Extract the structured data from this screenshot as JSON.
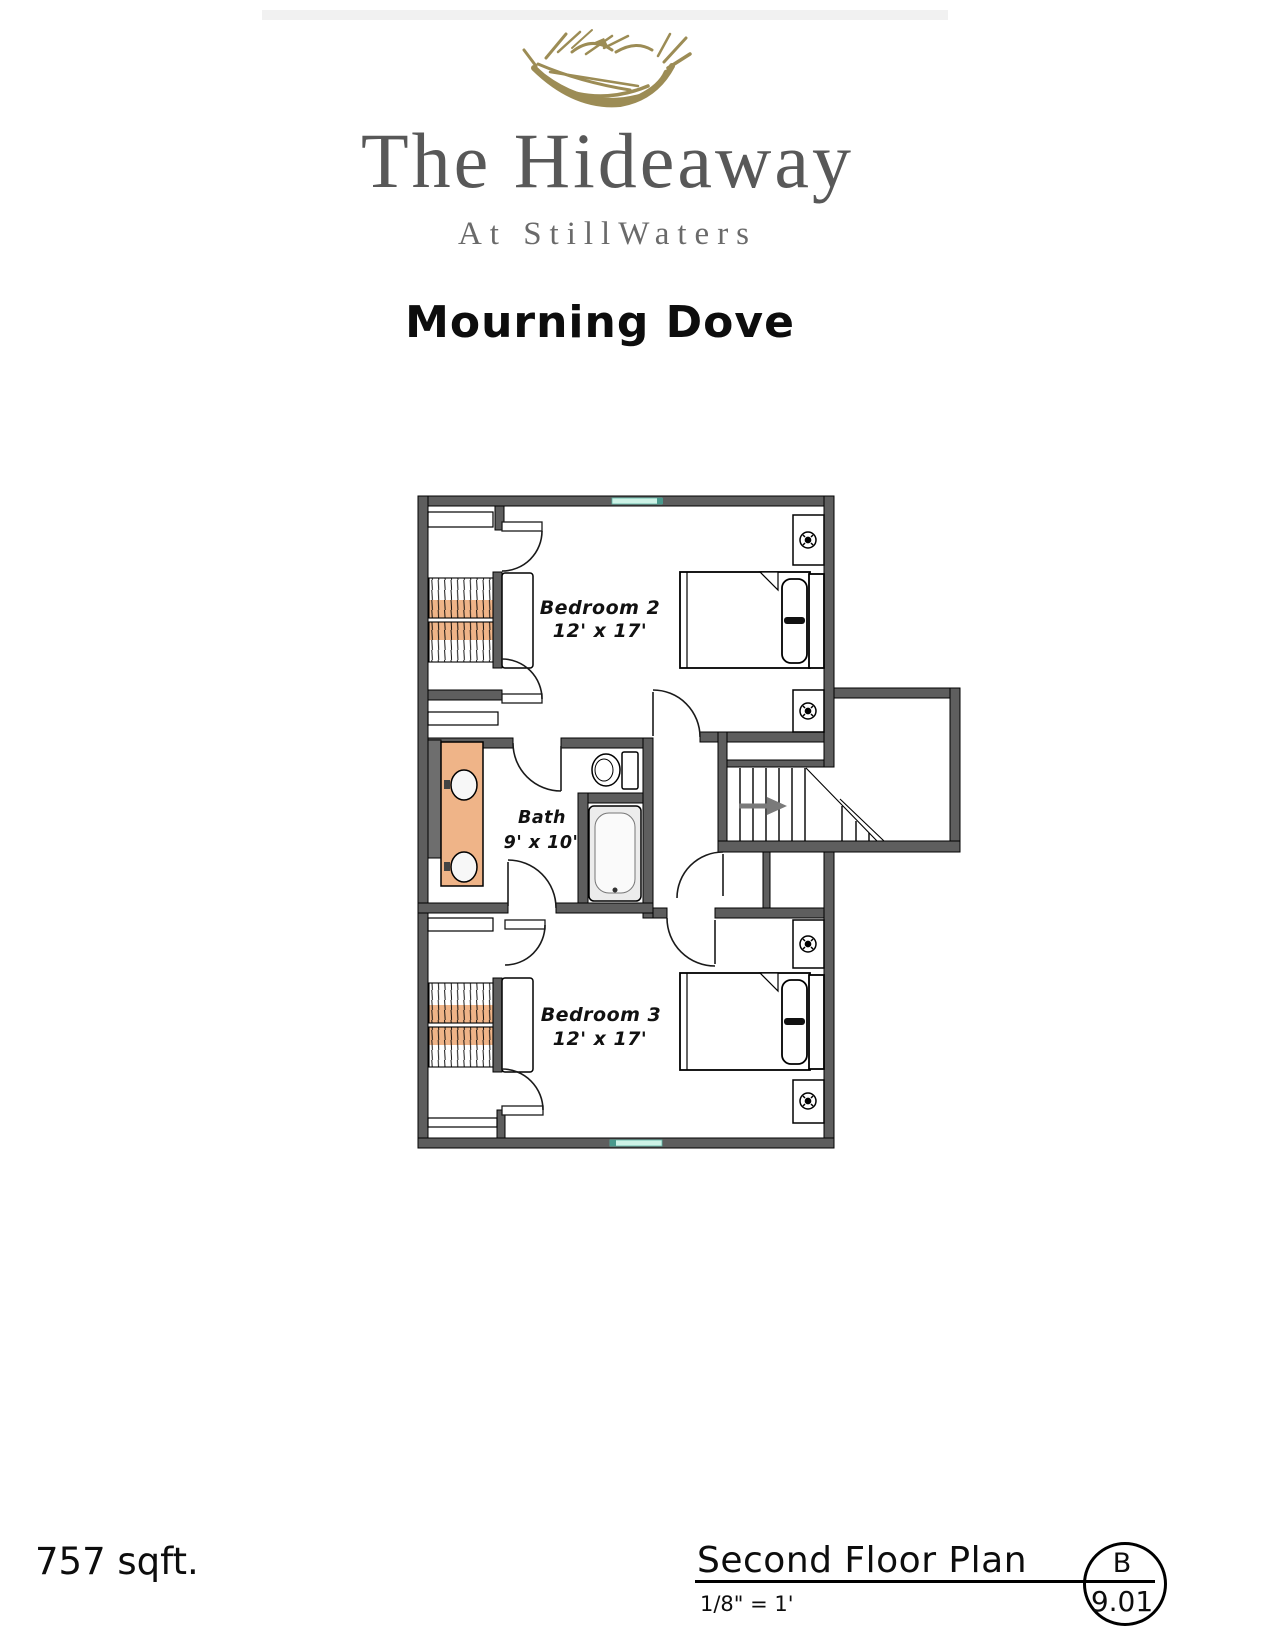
{
  "header": {
    "logo_icon": "bird-nest-logo",
    "logo_color": "#9c8c55",
    "brand_title": "The Hideaway",
    "brand_subtitle": "At StillWaters",
    "brand_color": "#585858",
    "plan_name": "Mourning Dove"
  },
  "floor_plan": {
    "wall_color": "#5e5e5e",
    "counter_color": "#efb488",
    "window_color": "#cdf2e6",
    "stair_arrow_color": "#7a7a7a",
    "rooms": [
      {
        "name": "Bedroom 2",
        "dimensions": "12' x 17'"
      },
      {
        "name": "Bath",
        "dimensions": "9' x 10'"
      },
      {
        "name": "Bedroom 3",
        "dimensions": "12' x 17'"
      }
    ]
  },
  "footer": {
    "area_label": "757 sqft.",
    "sheet_title": "Second Floor Plan",
    "scale_label": "1/8\" = 1'",
    "sheet_letter": "B",
    "sheet_number": "9.01"
  }
}
